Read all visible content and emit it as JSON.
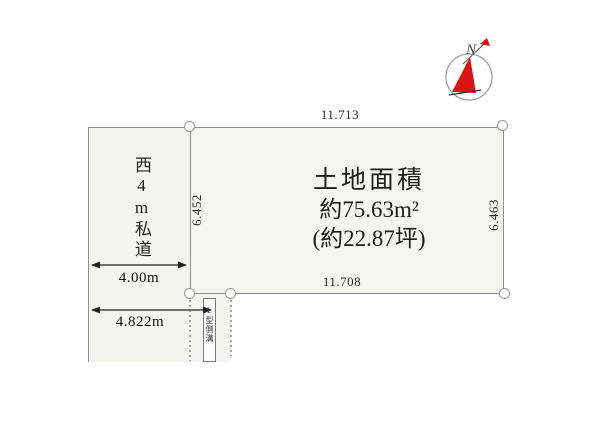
{
  "compass": {
    "north_label": "N"
  },
  "land": {
    "title": "土地面積",
    "area_sqm": "約75.63m²",
    "area_tsubo": "(約22.87坪)",
    "edge_top": "11.713",
    "edge_bottom": "11.708",
    "edge_left": "6.452",
    "edge_right": "6.463"
  },
  "road": {
    "name": "西4m私道",
    "width": "4.00m",
    "frontage": "4.822m"
  },
  "gutter": {
    "label": "L型側溝"
  },
  "colors": {
    "land_fill": "#f5f5f2",
    "road_fill": "#f4f4f1",
    "boundary_line": "#8f8f8f",
    "needle_red": "#d81414",
    "text": "#1e1e1e"
  }
}
